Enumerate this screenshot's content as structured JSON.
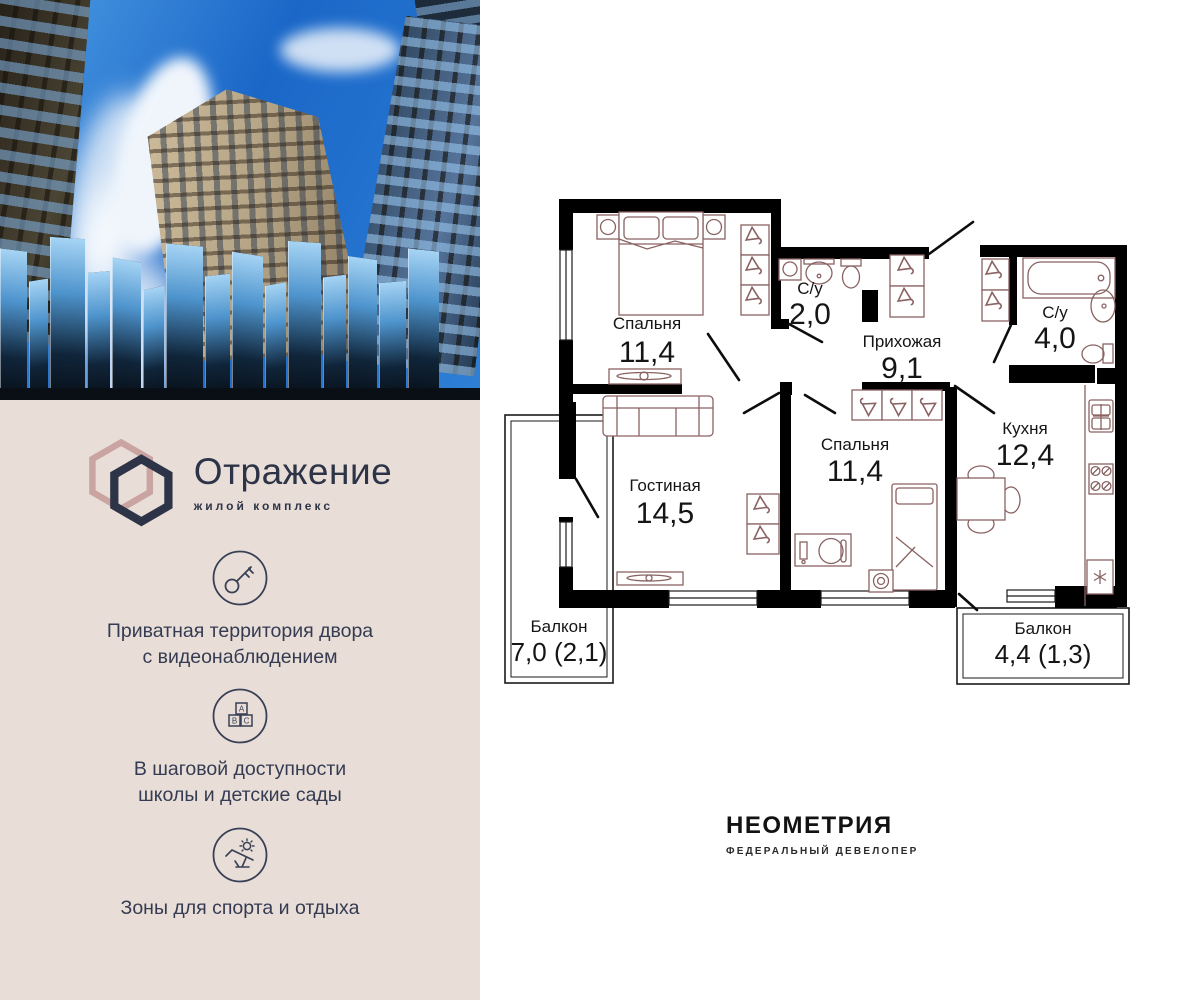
{
  "brand": {
    "title": "Отражение",
    "subtitle": "жилой комплекс",
    "colors": {
      "navy": "#2e3549",
      "rose": "#c9a4a1",
      "panel_bg": "#e9ded7"
    },
    "features": [
      {
        "icon": "key-icon",
        "lines": [
          "Приватная территория двора",
          "с видеонаблюдением"
        ]
      },
      {
        "icon": "abc-blocks-icon",
        "lines": [
          "В шаговой доступности",
          "школы и детские сады"
        ]
      },
      {
        "icon": "sun-lounger-icon",
        "lines": [
          "Зоны для спорта и отдыха"
        ]
      }
    ]
  },
  "plan": {
    "wall_color": "#000000",
    "furniture_color": "#8a6262",
    "rooms": [
      {
        "name": "Спальня",
        "area": "11,4"
      },
      {
        "name": "С/у",
        "area": "2,0"
      },
      {
        "name": "Прихожая",
        "area": "9,1"
      },
      {
        "name": "С/у",
        "area": "4,0"
      },
      {
        "name": "Гостиная",
        "area": "14,5"
      },
      {
        "name": "Спальня",
        "area": "11,4"
      },
      {
        "name": "Кухня",
        "area": "12,4"
      },
      {
        "name": "Балкон",
        "area": "7,0 (2,1)"
      },
      {
        "name": "Балкон",
        "area": "4,4 (1,3)"
      }
    ]
  },
  "developer": {
    "name": "НЕОМЕТРИЯ",
    "tagline": "ФЕДЕРАЛЬНЫЙ ДЕВЕЛОПЕР"
  }
}
